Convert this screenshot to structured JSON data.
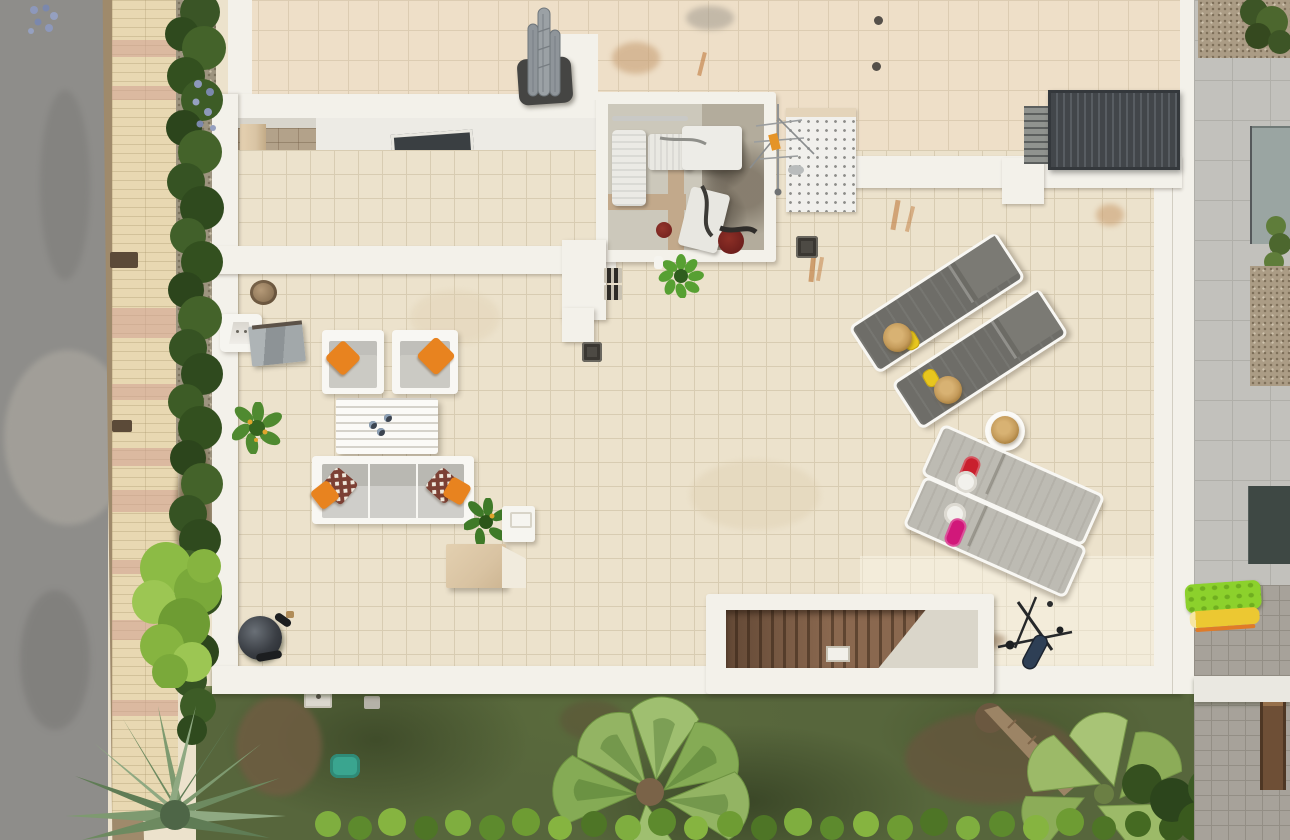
{
  "scene": {
    "type": "aerial-drone-photo",
    "subject": "top-down view of a modern white villa rooftop terrace with outdoor furniture, street and garden",
    "areas": [
      "street",
      "sidewalk",
      "hedgerow",
      "roof",
      "entrance-courtyard",
      "utility-enclosure",
      "pergola",
      "roof-terrace",
      "garden-stairwell",
      "lawn-garden",
      "neighbor-property"
    ],
    "furniture": {
      "armchairs": 2,
      "sofa": 1,
      "coffee_table": 1,
      "sun_loungers": 4,
      "round_side_table": 1,
      "straw_hats": 3,
      "grills": 2,
      "potted_plants": 4,
      "plinth_blocks": 1
    }
  },
  "palette": {
    "terrace_tile": "#ece2cc",
    "terrace_grout": "#d8ccb2",
    "roof_tile": "#eedfc8",
    "roof_grout": "#dcccb2",
    "wall_white": "#f3f1ea",
    "frame_white": "#f8f7f3",
    "road": "#8e8d8a",
    "road_light": "#a5a29b",
    "curb": "#9f8a6b",
    "sidewalk": "#e8d8b2",
    "sidewalk_pink": "#cfa091",
    "hedge_dark": "#2f4a1e",
    "hedge_mid": "#44632a",
    "hedge_light": "#5d8135",
    "bush_bright": "#8cbb45",
    "gravel": "#9d947f",
    "stone": "#b3a28a",
    "stair_light": "#d8d4c9",
    "stair_dark": "#bdb9ac",
    "pillar_tan": "#d9c4a4",
    "skylight": "#3a3f42",
    "lawn": "#57663c",
    "lawn_dark": "#414f2a",
    "dirt": "#6f5d42",
    "palm_gray_green": "#7e9a70",
    "palm_green": "#93b463",
    "palm_dark_green": "#6e9342",
    "trunk": "#9c8465",
    "steps_brown": "#8a684f",
    "steps_dark": "#5f4531",
    "landing": "#dad6ca",
    "cushion": "#cbcac4",
    "cushion_dark": "#b9b8b2",
    "pillow_orange": "#e8831f",
    "pillow_check": "#7c4034",
    "lounger_dark": "#6e6d68",
    "lounger_light": "#bdbbb3",
    "towel_red": "#c9202e",
    "towel_magenta": "#d1187a",
    "hat": "#c59c5c",
    "hat_dark": "#a9803f",
    "flipflop_yellow": "#e8c61e",
    "metal": "#9aa0a2",
    "enclosure_floor": "#b3ac9c",
    "enclosure_floor_light": "#ccc8bb",
    "divider_tan": "#c2a98b",
    "pot_red": "#6e1f1c",
    "pergola": "#42464a",
    "pergola_slat": "#585d62",
    "pergola_panel": "#90938f",
    "neighbor_concrete": "#c2c1bc",
    "neighbor_line": "#b0afa9",
    "cobble": "#a7a29a",
    "cobble_line": "#938e85",
    "neighbor_gravel": "#ab9c85",
    "glass": "#9aa5a2",
    "glass_dark": "#3e4844",
    "float_green": "#8cd12c",
    "float_yellow": "#ecc832",
    "float_orange": "#e07b28",
    "flower_pink": "#c75e85",
    "flower_blue": "#8d98bb",
    "teal": "#3aa58f",
    "grill_black": "#26282a",
    "grill_navy": "#2e3f55",
    "sculpture_gray": "#9ba1a5",
    "sculpture_base": "#454543",
    "rust": "#bf7a3c"
  }
}
